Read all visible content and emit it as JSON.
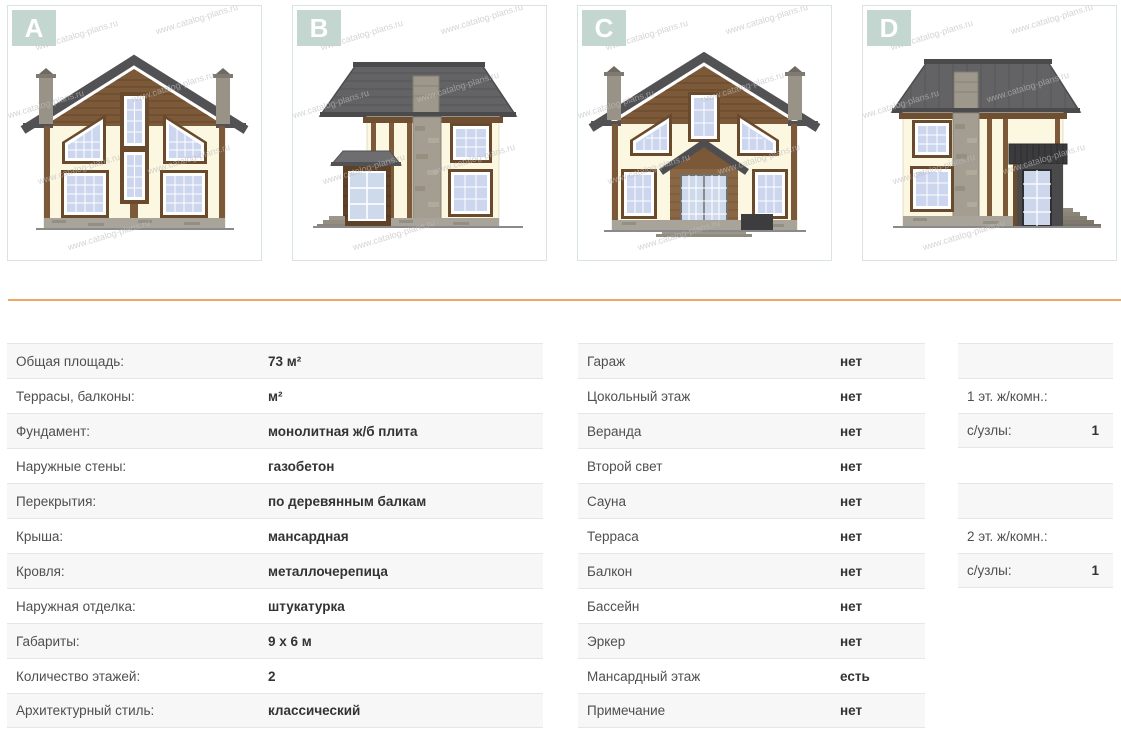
{
  "watermark": "www.catalog-plans.ru",
  "facades": [
    {
      "label": "A",
      "name": "facade-a"
    },
    {
      "label": "B",
      "name": "facade-b"
    },
    {
      "label": "C",
      "name": "facade-c"
    },
    {
      "label": "D",
      "name": "facade-d"
    }
  ],
  "specs_left": {
    "rows": [
      {
        "label": "Общая площадь:",
        "value": "73 м²"
      },
      {
        "label": "Террасы, балконы:",
        "value": "м²"
      },
      {
        "label": "Фундамент:",
        "value": "монолитная ж/б плита"
      },
      {
        "label": "Наружные стены:",
        "value": "газобетон"
      },
      {
        "label": "Перекрытия:",
        "value": "по деревянным балкам"
      },
      {
        "label": "Крыша:",
        "value": "мансардная"
      },
      {
        "label": "Кровля:",
        "value": "металлочерепица"
      },
      {
        "label": "Наружная отделка:",
        "value": "штукатурка"
      },
      {
        "label": "Габариты:",
        "value": "9 x 6 м"
      },
      {
        "label": "Количество этажей:",
        "value": "2"
      },
      {
        "label": "Архитектурный стиль:",
        "value": "классический"
      }
    ]
  },
  "specs_middle": {
    "rows": [
      {
        "label": "Гараж",
        "value": "нет"
      },
      {
        "label": "Цокольный этаж",
        "value": "нет"
      },
      {
        "label": "Веранда",
        "value": "нет"
      },
      {
        "label": "Второй свет",
        "value": "нет"
      },
      {
        "label": "Сауна",
        "value": "нет"
      },
      {
        "label": "Терраса",
        "value": "нет"
      },
      {
        "label": "Балкон",
        "value": "нет"
      },
      {
        "label": "Бассейн",
        "value": "нет"
      },
      {
        "label": "Эркер",
        "value": "нет"
      },
      {
        "label": "Мансардный этаж",
        "value": "есть"
      },
      {
        "label": "Примечание",
        "value": "нет"
      }
    ]
  },
  "specs_right": {
    "floor1": [
      {
        "label": "",
        "value": ""
      },
      {
        "label": "1 эт. ж/комн.:",
        "value": ""
      },
      {
        "label": "с/узлы:",
        "value": "1"
      }
    ],
    "floor2": [
      {
        "label": "",
        "value": ""
      },
      {
        "label": "2 эт. ж/комн.:",
        "value": ""
      },
      {
        "label": "с/узлы:",
        "value": "1"
      }
    ]
  },
  "colors": {
    "divider": "#eba76a",
    "badge_bg": "#c3d6cf",
    "row_stripe": "#f7f7f7"
  }
}
